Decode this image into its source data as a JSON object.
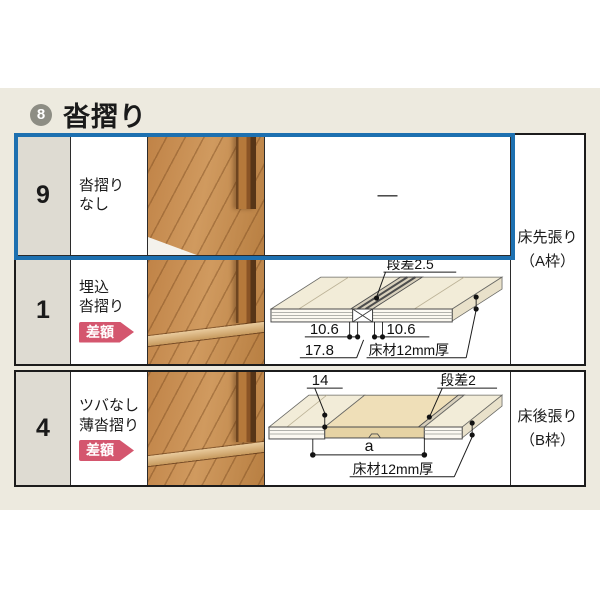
{
  "section": {
    "number": "8",
    "title": "沓摺り"
  },
  "colors": {
    "highlight_blue": "#1d70b0",
    "badge_pink": "#d4566e"
  },
  "tableA": {
    "side_label": {
      "line1": "床先張り",
      "line2": "（A枠）"
    },
    "rows": [
      {
        "num": "9",
        "name1": "沓摺り",
        "name2": "なし",
        "diagram_placeholder": "—"
      },
      {
        "num": "1",
        "name1": "埋込",
        "name2": "沓摺り",
        "badge": "差額"
      }
    ]
  },
  "tableB": {
    "side_label": {
      "line1": "床後張り",
      "line2": "（B枠）"
    },
    "rows": [
      {
        "num": "4",
        "name1": "ツバなし",
        "name2": "薄沓摺り",
        "badge": "差額"
      }
    ]
  },
  "diagram_row1": {
    "step": "段差2.5",
    "dim_left": "10.6",
    "dim_right": "10.6",
    "dim_total": "17.8",
    "material": "床材12mm厚"
  },
  "diagram_row4": {
    "thickness": "14",
    "step": "段差2",
    "span": "a",
    "material": "床材12mm厚"
  }
}
